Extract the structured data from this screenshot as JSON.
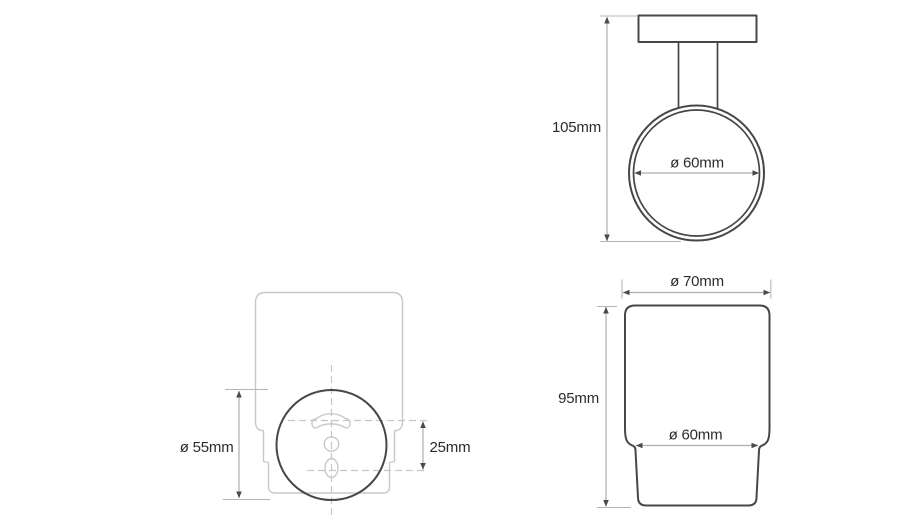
{
  "drawing": {
    "kind": "technical-dimension-drawing",
    "subject": "wall-mounted tumbler holder with glass cup"
  },
  "colors": {
    "background": "#ffffff",
    "outline": "#474747",
    "ghost_line": "#c9c9c9",
    "dimension_line": "#aeaeae",
    "centerline": "#c6c6c6",
    "arrow": "#4a4a4a",
    "label_text": "#2b2b2b"
  },
  "views": {
    "holder_front": {
      "height": "105mm",
      "ring_inner_diameter": "ø 60mm"
    },
    "tumbler_front": {
      "top_diameter": "ø 70mm",
      "height": "95mm",
      "bottom_diameter": "ø 60mm"
    },
    "holder_back": {
      "plate_diameter": "ø 55mm",
      "mounting_hole_spacing": "25mm"
    }
  }
}
